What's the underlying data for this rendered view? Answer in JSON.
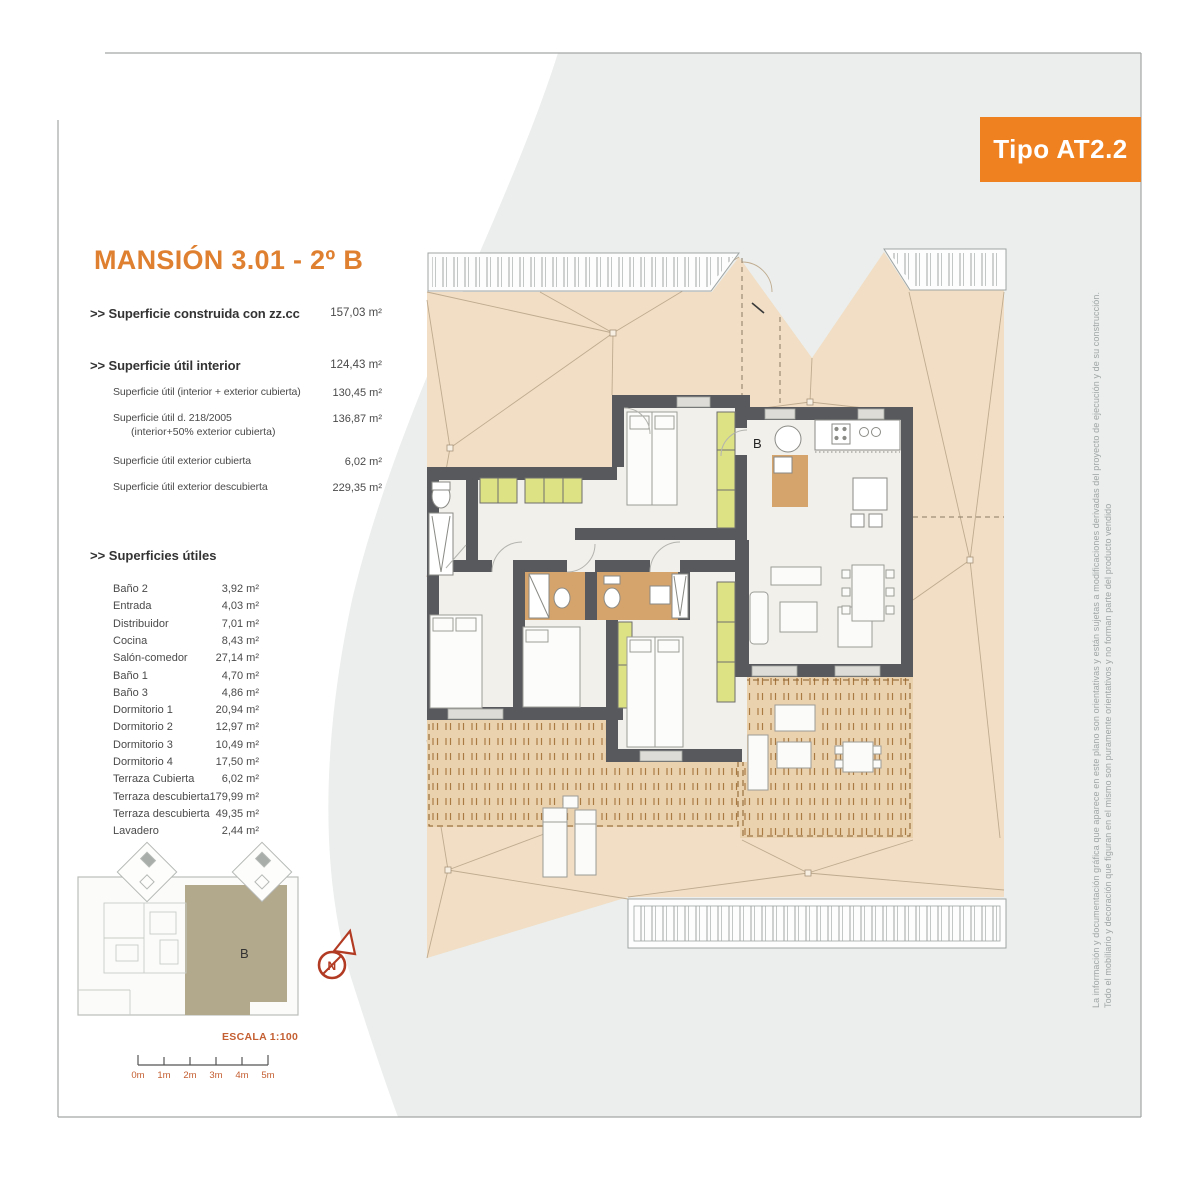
{
  "badge": "Tipo AT2.2",
  "title": "MANSIÓN 3.01 - 2º B",
  "summary": {
    "rows": [
      {
        "label": ">> Superficie construida con zz.cc",
        "value": "157,03 m²"
      },
      {
        "label": ">> Superficie útil interior",
        "value": "124,43 m²"
      },
      {
        "label": "Superficie útil (interior + exterior cubierta)",
        "value": "130,45 m²"
      },
      {
        "label": "Superficie útil  d. 218/2005",
        "label2": "(interior+50% exterior cubierta)",
        "value": "136,87 m²"
      },
      {
        "label": "Superficie útil exterior cubierta",
        "value": "6,02 m²"
      },
      {
        "label": "Superficie útil exterior descubierta",
        "value": "229,35 m²"
      }
    ]
  },
  "superficies": {
    "header": ">> Superficies útiles",
    "rows": [
      {
        "label": "Baño 2",
        "value": "3,92 m²"
      },
      {
        "label": "Entrada",
        "value": "4,03 m²"
      },
      {
        "label": "Distribuidor",
        "value": "7,01 m²"
      },
      {
        "label": "Cocina",
        "value": "8,43 m²"
      },
      {
        "label": "Salón-comedor",
        "value": "27,14 m²"
      },
      {
        "label": "Baño 1",
        "value": "4,70 m²"
      },
      {
        "label": "Baño 3",
        "value": "4,86 m²"
      },
      {
        "label": "Dormitorio 1",
        "value": "20,94 m²"
      },
      {
        "label": "Dormitorio 2",
        "value": "12,97 m²"
      },
      {
        "label": "Dormitorio 3",
        "value": "10,49 m²"
      },
      {
        "label": "Dormitorio 4",
        "value": "17,50 m²"
      },
      {
        "label": "Terraza Cubierta",
        "value": "6,02 m²"
      },
      {
        "label": "Terraza descubierta",
        "value": "179,99 m²"
      },
      {
        "label": "Terraza descubierta",
        "value": "49,35 m²"
      },
      {
        "label": "Lavadero",
        "value": "2,44 m²"
      }
    ]
  },
  "scale": {
    "escala": "ESCALA 1:100",
    "labels": [
      "0m",
      "1m",
      "2m",
      "3m",
      "4m",
      "5m"
    ]
  },
  "plan": {
    "entrance_label": "B",
    "keyplan_label": "B",
    "north_label": "N"
  },
  "disclaimer": {
    "line1": "La información y documentación gráfica que aparece en este plano son orientativas y están sujetas a modificaciones derivadas del proyecto de ejecución y de su construcción.",
    "line2": "Todo el mobiliario y decoración que figuran en el mismo son puramente orientativos y no forman parte del producto vendido"
  },
  "colors": {
    "accent_orange": "#ef8121",
    "title_orange": "#df8030",
    "scale_red": "#c45f32",
    "roof_tan": "#f1dec4",
    "deck_tan": "#ebd2ae",
    "wall_gray": "#58595d",
    "closet_yellow": "#dde284",
    "bath_brown": "#d5a36c",
    "keyplan_khaki": "#b2a88b",
    "compass_red": "#b23b24",
    "background_gray": "#ebeeec"
  }
}
